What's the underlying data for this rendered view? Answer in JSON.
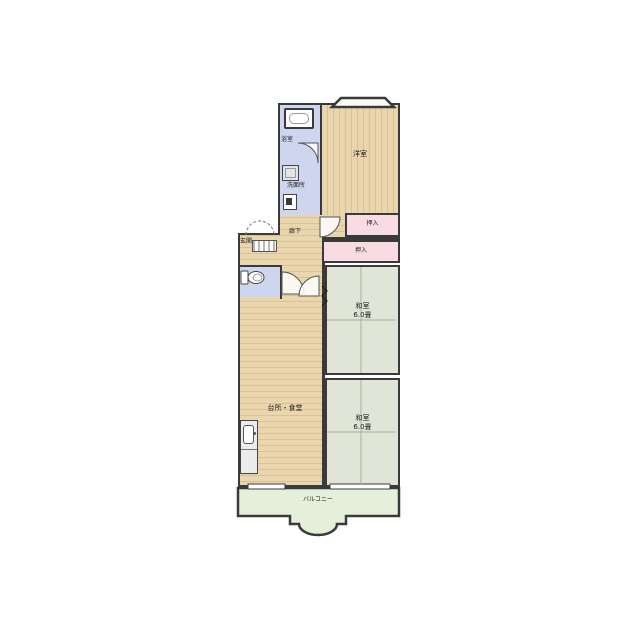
{
  "floor_plan": {
    "rooms": {
      "bathroom": {
        "label": "浴室"
      },
      "washroom": {
        "label": "洗面所"
      },
      "entrance": {
        "label": "玄関"
      },
      "hallway": {
        "label": "廊下"
      },
      "western_room": {
        "label": "洋室"
      },
      "closet_upper": {
        "label": "押入"
      },
      "closet_lower": {
        "label": "押入"
      },
      "kitchen_dining": {
        "label": "台所・食堂"
      },
      "tatami_room_1": {
        "label": "和室",
        "size": "6.0畳"
      },
      "tatami_room_2": {
        "label": "和室",
        "size": "6.0畳"
      },
      "balcony": {
        "label": "バルコニー"
      }
    },
    "colors": {
      "wall": "#3a3a3a",
      "wood_floor": "#e9d6ae",
      "wood_floor_stripe": "#d9c191",
      "tatami": "#e0e5d7",
      "tatami_line": "#a7b199",
      "closet": "#f9dce3",
      "wet_area": "#cdd6ee",
      "balcony": "#e4f0da"
    },
    "icons": [
      "bathtub-icon",
      "washing-machine-icon",
      "sink-icon",
      "toilet-icon",
      "kitchen-sink-icon",
      "entry-mat-icon",
      "door-swing-icon",
      "sliding-door-icon"
    ]
  }
}
